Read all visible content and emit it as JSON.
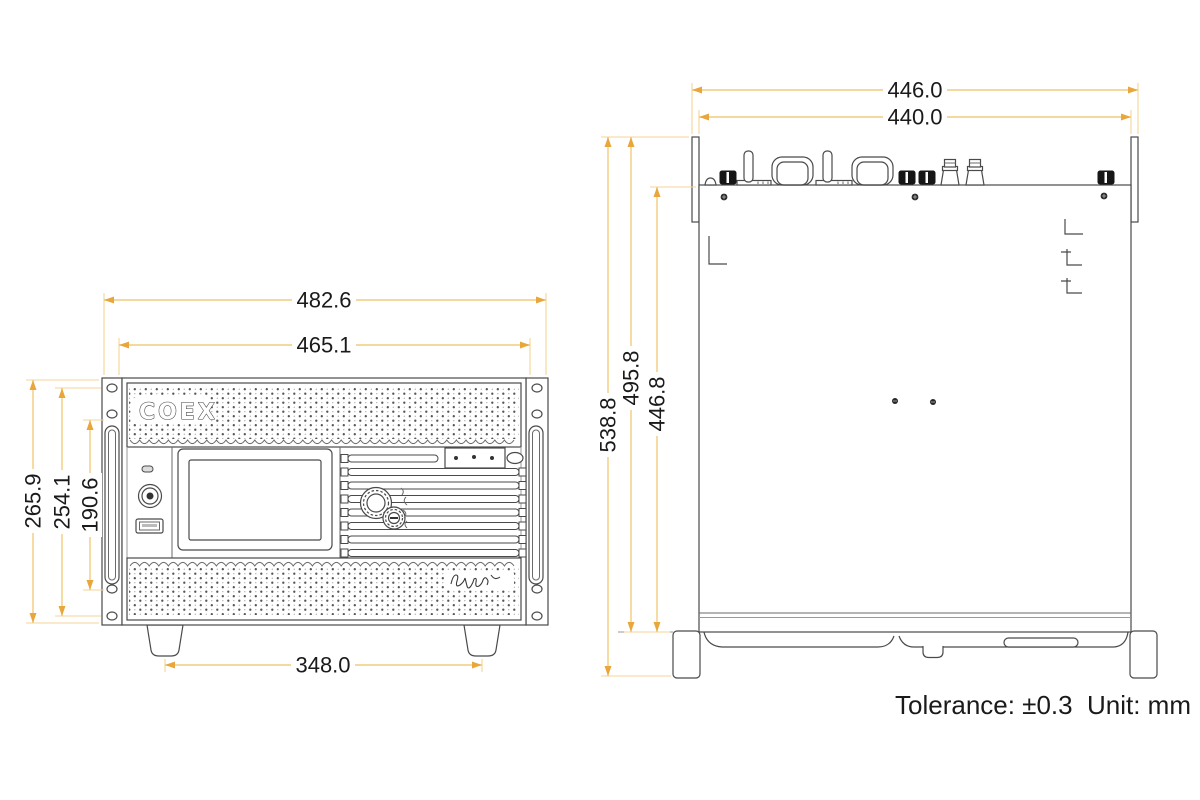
{
  "brand": {
    "logo_text": "COEX"
  },
  "front_view": {
    "dimensions": {
      "overall_width_mm": "482.6",
      "panel_width_mm": "465.1",
      "overall_height_mm": "265.9",
      "ear_hole_span_mm": "254.1",
      "handle_span_mm": "190.6",
      "feet_spacing_mm": "348.0"
    }
  },
  "top_view": {
    "dimensions": {
      "overall_width_mm": "446.0",
      "body_width_mm": "440.0",
      "overall_depth_mm": "538.8",
      "depth_with_rear_connectors_mm": "495.8",
      "body_depth_mm": "446.8"
    }
  },
  "notes": {
    "tolerance": "Tolerance: ±0.3",
    "unit": "Unit: mm"
  },
  "colors": {
    "dimension_line": "#f2cc7d",
    "dimension_arrow": "#e9a63a",
    "drawing_line": "#4a4a4a",
    "text": "#1a1a1a",
    "background": "#ffffff"
  }
}
